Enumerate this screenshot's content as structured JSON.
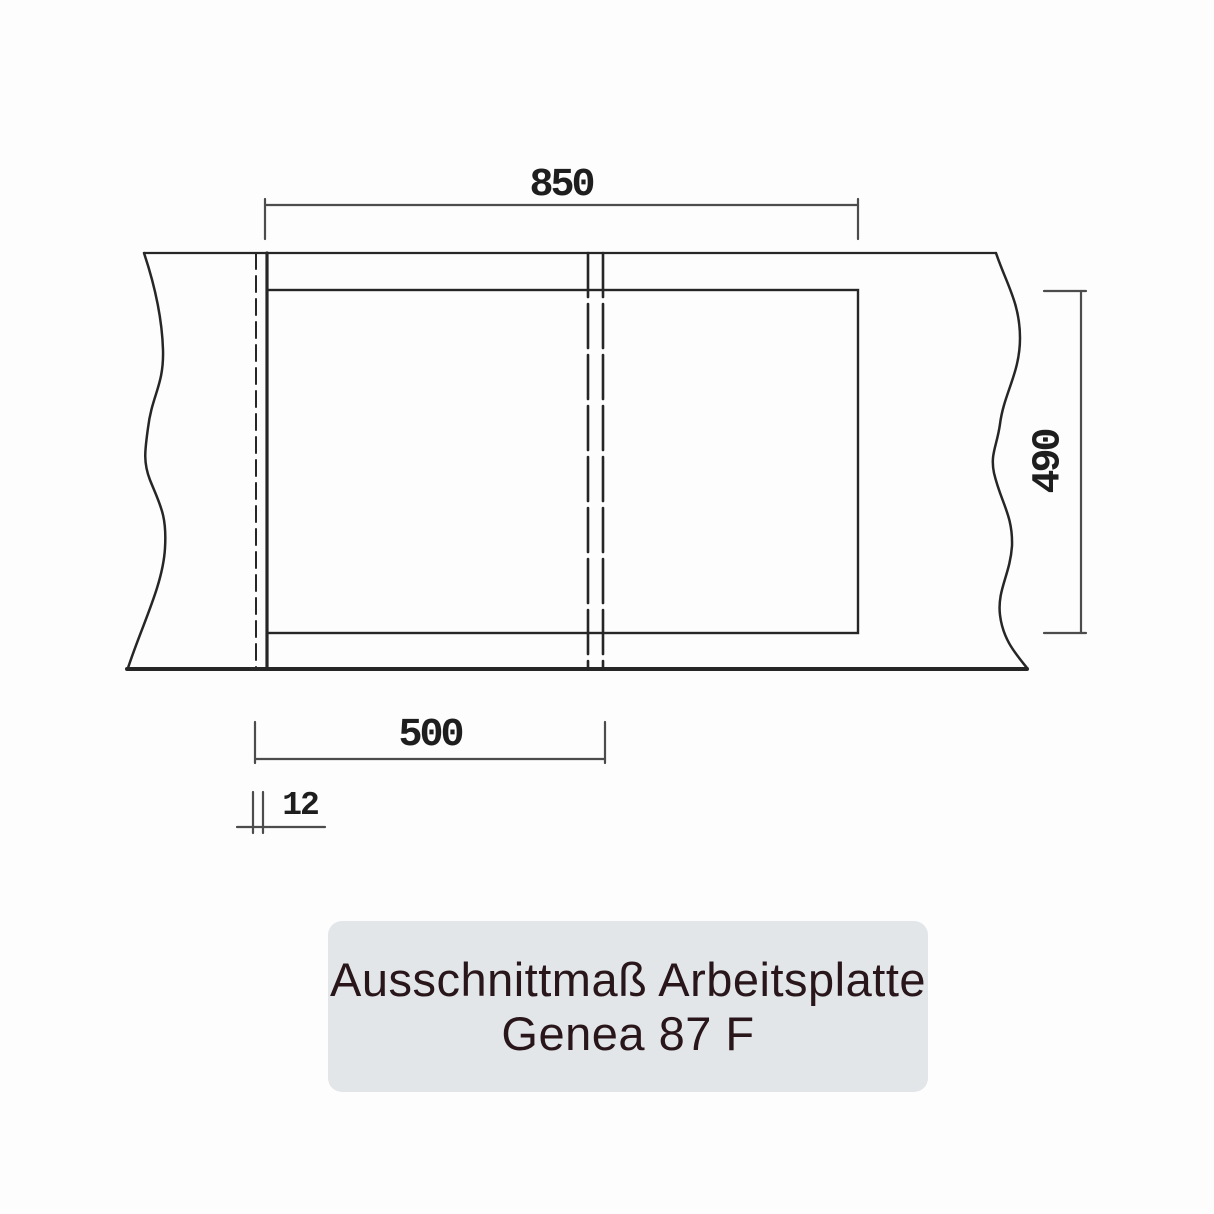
{
  "drawing": {
    "dimensions": {
      "cutout_width_mm": "850",
      "cutout_depth_mm": "490",
      "left_bowl_width_mm": "500",
      "edge_distance_mm": "12"
    }
  },
  "caption": {
    "line1": "Ausschnittmaß Arbeitsplatte",
    "line2": "Genea 87 F"
  },
  "colors": {
    "page-bg": "#fdfdfd",
    "object-line": "#262626",
    "dim-line": "#4c4c4c",
    "panel-bg": "#e2e6e9",
    "panel-text": "#29161a",
    "label-color": "#1e1e1e"
  }
}
